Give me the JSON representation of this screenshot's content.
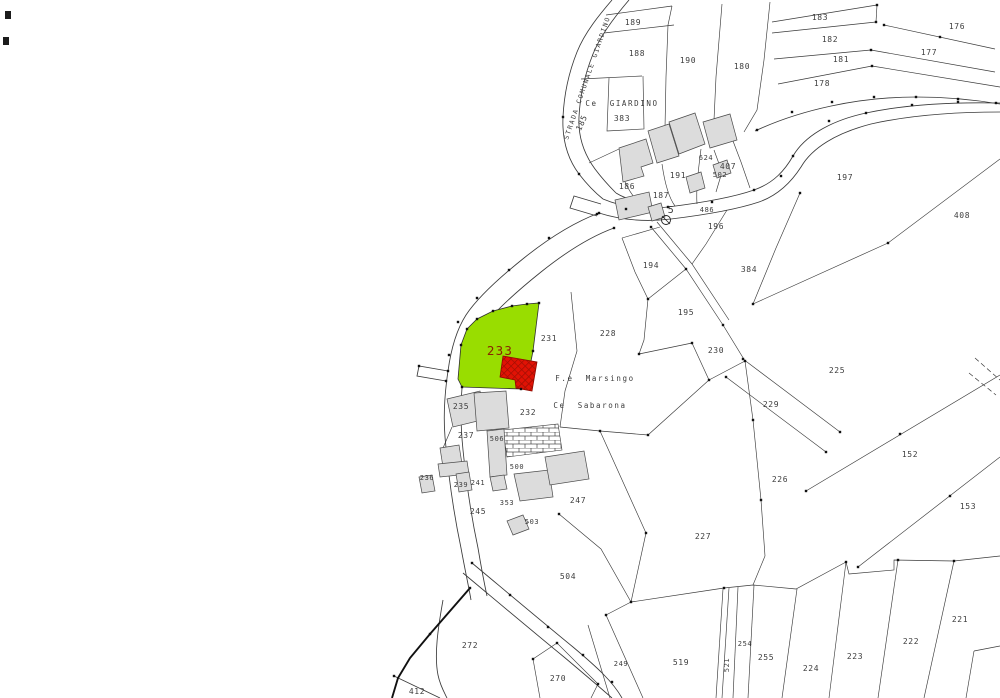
{
  "map": {
    "colors": {
      "background": "#ffffff",
      "line": "#3a3a3a",
      "label": "#3d3d3d",
      "building_fill": "#dcdcdc",
      "building_stroke": "#4a4a4a",
      "highlight_fill": "#99dd00",
      "highlight_label": "#8a2500",
      "red_building_fill": "#e11205",
      "red_building_hatch": "#8f0a00"
    },
    "highlight_parcel": {
      "id": "233"
    },
    "well_symbol_label": "5",
    "street_label": {
      "name": "street-label-strada-comunale-giardino",
      "text": "STRADA COMUNALE GIARDINO"
    },
    "labels": [
      {
        "name": "parcel-label-189",
        "text": "189",
        "x": 633,
        "y": 25
      },
      {
        "name": "parcel-label-188",
        "text": "188",
        "x": 637,
        "y": 56
      },
      {
        "name": "parcel-label-190",
        "text": "190",
        "x": 688,
        "y": 63
      },
      {
        "name": "parcel-label-180",
        "text": "180",
        "x": 742,
        "y": 69
      },
      {
        "name": "parcel-label-183",
        "text": "183",
        "x": 820,
        "y": 20
      },
      {
        "name": "parcel-label-182",
        "text": "182",
        "x": 830,
        "y": 42
      },
      {
        "name": "parcel-label-181",
        "text": "181",
        "x": 841,
        "y": 62
      },
      {
        "name": "parcel-label-178",
        "text": "178",
        "x": 822,
        "y": 86
      },
      {
        "name": "parcel-label-176",
        "text": "176",
        "x": 957,
        "y": 29
      },
      {
        "name": "parcel-label-177",
        "text": "177",
        "x": 929,
        "y": 55
      },
      {
        "name": "parcel-label-197",
        "text": "197",
        "x": 845,
        "y": 180
      },
      {
        "name": "parcel-label-408",
        "text": "408",
        "x": 962,
        "y": 218
      },
      {
        "name": "place-label-ce-giardino",
        "text": "Ce GIARDINO",
        "x": 622,
        "y": 106,
        "cls": "lbl place"
      },
      {
        "name": "parcel-label-383",
        "text": "383",
        "x": 622,
        "y": 121
      },
      {
        "name": "parcel-label-185",
        "text": "185",
        "x": 584,
        "y": 124,
        "rot": -65
      },
      {
        "name": "parcel-label-186",
        "text": "186",
        "x": 627,
        "y": 189
      },
      {
        "name": "parcel-label-187",
        "text": "187",
        "x": 661,
        "y": 198
      },
      {
        "name": "parcel-label-191",
        "text": "191",
        "x": 678,
        "y": 178
      },
      {
        "name": "parcel-label-624",
        "text": "624",
        "x": 706,
        "y": 160,
        "cls": "lbl small"
      },
      {
        "name": "parcel-label-407",
        "text": "407",
        "x": 728,
        "y": 169
      },
      {
        "name": "parcel-label-502",
        "text": "502",
        "x": 720,
        "y": 177,
        "cls": "lbl small"
      },
      {
        "name": "parcel-label-486",
        "text": "486",
        "x": 707,
        "y": 212,
        "cls": "lbl small"
      },
      {
        "name": "well-label-5",
        "text": "5",
        "x": 671,
        "y": 213,
        "size": 10
      },
      {
        "name": "parcel-label-196",
        "text": "196",
        "x": 716,
        "y": 229
      },
      {
        "name": "parcel-label-194",
        "text": "194",
        "x": 651,
        "y": 268
      },
      {
        "name": "parcel-label-384",
        "text": "384",
        "x": 749,
        "y": 272
      },
      {
        "name": "parcel-label-195",
        "text": "195",
        "x": 686,
        "y": 315
      },
      {
        "name": "parcel-label-230",
        "text": "230",
        "x": 716,
        "y": 353
      },
      {
        "name": "parcel-label-228",
        "text": "228",
        "x": 608,
        "y": 336
      },
      {
        "name": "parcel-label-231",
        "text": "231",
        "x": 549,
        "y": 341
      },
      {
        "name": "parcel-label-233",
        "text": "233",
        "x": 500,
        "y": 355,
        "cls": "lbl big"
      },
      {
        "name": "place-label-fe-marsingo",
        "text": "F.e Marsingo",
        "x": 595,
        "y": 381,
        "cls": "lbl place"
      },
      {
        "name": "place-label-ce-sabarona",
        "text": "Ce Sabarona",
        "x": 590,
        "y": 408,
        "cls": "lbl place"
      },
      {
        "name": "parcel-label-232",
        "text": "232",
        "x": 528,
        "y": 415
      },
      {
        "name": "parcel-label-225",
        "text": "225",
        "x": 837,
        "y": 373
      },
      {
        "name": "parcel-label-229",
        "text": "229",
        "x": 771,
        "y": 407
      },
      {
        "name": "parcel-label-226",
        "text": "226",
        "x": 780,
        "y": 482
      },
      {
        "name": "parcel-label-152",
        "text": "152",
        "x": 910,
        "y": 457
      },
      {
        "name": "parcel-label-153",
        "text": "153",
        "x": 968,
        "y": 509
      },
      {
        "name": "parcel-label-227",
        "text": "227",
        "x": 703,
        "y": 539
      },
      {
        "name": "parcel-label-247",
        "text": "247",
        "x": 578,
        "y": 503
      },
      {
        "name": "parcel-label-235",
        "text": "235",
        "x": 461,
        "y": 409
      },
      {
        "name": "parcel-label-237",
        "text": "237",
        "x": 466,
        "y": 438
      },
      {
        "name": "parcel-label-506",
        "text": "506",
        "x": 497,
        "y": 441,
        "cls": "lbl small"
      },
      {
        "name": "parcel-label-500",
        "text": "500",
        "x": 517,
        "y": 469,
        "cls": "lbl small"
      },
      {
        "name": "parcel-label-236",
        "text": "236",
        "x": 427,
        "y": 480,
        "cls": "lbl small"
      },
      {
        "name": "parcel-label-239",
        "text": "239",
        "x": 461,
        "y": 487,
        "cls": "lbl small"
      },
      {
        "name": "parcel-label-241",
        "text": "241",
        "x": 478,
        "y": 485,
        "cls": "lbl small"
      },
      {
        "name": "parcel-label-245",
        "text": "245",
        "x": 478,
        "y": 514
      },
      {
        "name": "parcel-label-353",
        "text": "353",
        "x": 507,
        "y": 505,
        "cls": "lbl small"
      },
      {
        "name": "parcel-label-503",
        "text": "503",
        "x": 532,
        "y": 524,
        "cls": "lbl small"
      },
      {
        "name": "parcel-label-504",
        "text": "504",
        "x": 568,
        "y": 579
      },
      {
        "name": "parcel-label-272",
        "text": "272",
        "x": 470,
        "y": 648
      },
      {
        "name": "parcel-label-270",
        "text": "270",
        "x": 558,
        "y": 681
      },
      {
        "name": "parcel-label-412",
        "text": "412",
        "x": 417,
        "y": 694
      },
      {
        "name": "parcel-label-249",
        "text": "249",
        "x": 621,
        "y": 666,
        "cls": "lbl small"
      },
      {
        "name": "parcel-label-519",
        "text": "519",
        "x": 681,
        "y": 665
      },
      {
        "name": "parcel-label-521",
        "text": "521",
        "x": 729,
        "y": 665,
        "rot": -90,
        "cls": "lbl small"
      },
      {
        "name": "parcel-label-254",
        "text": "254",
        "x": 745,
        "y": 646,
        "cls": "lbl small"
      },
      {
        "name": "parcel-label-255",
        "text": "255",
        "x": 766,
        "y": 660
      },
      {
        "name": "parcel-label-224",
        "text": "224",
        "x": 811,
        "y": 671
      },
      {
        "name": "parcel-label-223",
        "text": "223",
        "x": 855,
        "y": 659
      },
      {
        "name": "parcel-label-222",
        "text": "222",
        "x": 911,
        "y": 644
      },
      {
        "name": "parcel-label-221",
        "text": "221",
        "x": 960,
        "y": 622
      }
    ]
  }
}
